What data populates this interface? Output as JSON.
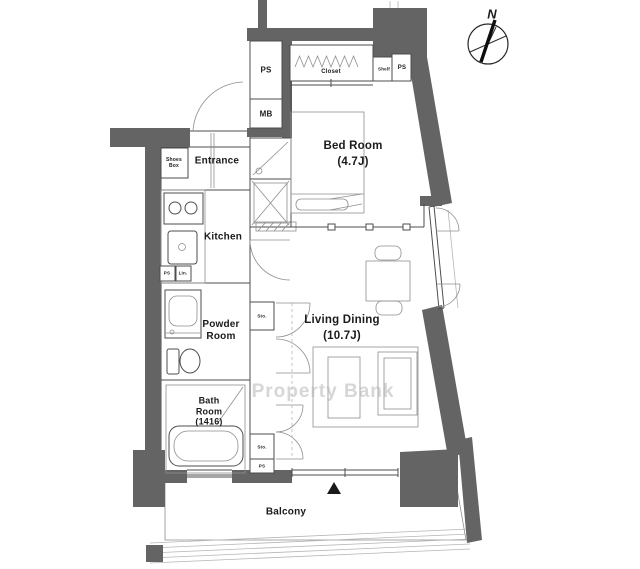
{
  "plan": {
    "watermark": "Property Bank",
    "compass": {
      "north_label": "N"
    },
    "rooms": {
      "entrance": {
        "name": "Entrance"
      },
      "kitchen": {
        "name": "Kitchen"
      },
      "bedroom": {
        "name": "Bed Room",
        "size": "(4.7J)"
      },
      "living_dining": {
        "name": "Living Dining",
        "size": "(10.7J)"
      },
      "powder_room": {
        "line1": "Powder",
        "line2": "Room"
      },
      "bath_room": {
        "line1": "Bath",
        "line2": "Room",
        "size": "(1416)"
      },
      "balcony": {
        "name": "Balcony"
      }
    },
    "labels": {
      "shoes_box_line1": "Shoes",
      "shoes_box_line2": "Box",
      "pipe_space_top": "PS",
      "meter_box": "MB",
      "closet": "Closet",
      "shelf": "Shelf",
      "pipe_space_closet": "PS",
      "pipe_space_kitchen": "PS",
      "linen": "Lin.",
      "storage_upper": "Sto.",
      "storage_lower": "Sto.",
      "pipe_space_storage": "PS"
    },
    "colors": {
      "wall": "#646464",
      "line": "#4d4d4d",
      "text": "#1b1b1b",
      "watermark": "#b5b5b5"
    }
  }
}
